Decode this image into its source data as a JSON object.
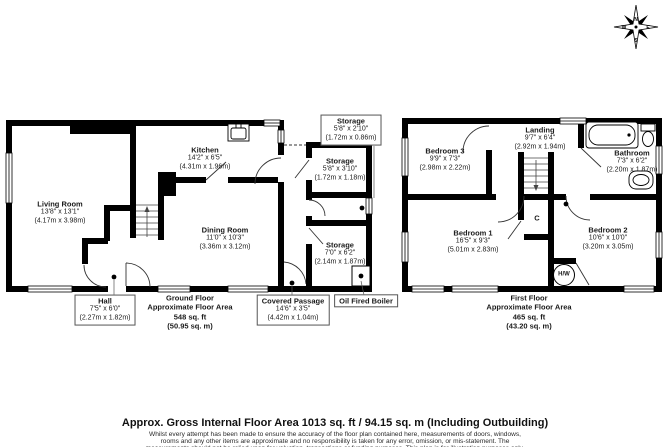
{
  "compass": {
    "n": "N",
    "s": "S",
    "e": "E",
    "w": "W"
  },
  "ground_floor": {
    "rooms": {
      "living_room": {
        "name": "Living Room",
        "imperial": "13'8\" x 13'1\"",
        "metric": "(4.17m x 3.98m)"
      },
      "kitchen": {
        "name": "Kitchen",
        "imperial": "14'2\" x 6'5\"",
        "metric": "(4.31m x 1.96m)"
      },
      "dining_room": {
        "name": "Dining Room",
        "imperial": "11'0\" x 10'3\"",
        "metric": "(3.36m x 3.12m)"
      },
      "hall": {
        "name": "Hall",
        "imperial": "7'5\" x 6'0\"",
        "metric": "(2.27m x 1.82m)"
      }
    },
    "summary": [
      "Ground Floor",
      "Approximate Floor Area",
      "548 sq. ft",
      "(50.95 sq. m)"
    ]
  },
  "outbuilding": {
    "rooms": {
      "storage_top": {
        "name": "Storage",
        "imperial": "5'8\" x 2'10\"",
        "metric": "(1.72m x 0.86m)"
      },
      "storage_mid": {
        "name": "Storage",
        "imperial": "5'8\" x 3'10\"",
        "metric": "(1.72m x 1.18m)"
      },
      "storage_low": {
        "name": "Storage",
        "imperial": "7'0\" x 6'2\"",
        "metric": "(2.14m x 1.87m)"
      },
      "covered_passage": {
        "name": "Covered Passage",
        "imperial": "14'6\" x 3'5\"",
        "metric": "(4.42m x 1.04m)"
      },
      "oil_boiler": {
        "name": "Oil Fired Boiler"
      }
    }
  },
  "first_floor": {
    "rooms": {
      "bedroom3": {
        "name": "Bedroom 3",
        "imperial": "9'9\" x 7'3\"",
        "metric": "(2.98m x 2.22m)"
      },
      "landing": {
        "name": "Landing",
        "imperial": "9'7\" x 6'4\"",
        "metric": "(2.92m x 1.94m)"
      },
      "bathroom": {
        "name": "Bathroom",
        "imperial": "7'3\" x 6'2\"",
        "metric": "(2.20m x 1.87m)"
      },
      "bedroom1": {
        "name": "Bedroom 1",
        "imperial": "16'5\" x 9'3\"",
        "metric": "(5.01m x 2.83m)"
      },
      "bedroom2": {
        "name": "Bedroom 2",
        "imperial": "10'6\" x 10'0\"",
        "metric": "(3.20m x 3.05m)"
      },
      "cupboard": {
        "label": "C"
      },
      "hot_water": {
        "label": "H/W"
      }
    },
    "summary": [
      "First Floor",
      "Approximate Floor Area",
      "465 sq. ft",
      "(43.20 sq. m)"
    ]
  },
  "footer": {
    "title": "Approx. Gross Internal Floor Area 1013 sq. ft / 94.15 sq. m (Including Outbuilding)",
    "lines": [
      "Whilst every attempt has been made to ensure the accuracy of the floor plan contained here, measurements of doors, windows,",
      "rooms and any other items are approximate and no responsibility is taken for any error, omission, or mis-statement. The",
      "measurements should not be relied upon for valuation, transactions or funding purposes. This plan is for illustration purposes only."
    ]
  }
}
